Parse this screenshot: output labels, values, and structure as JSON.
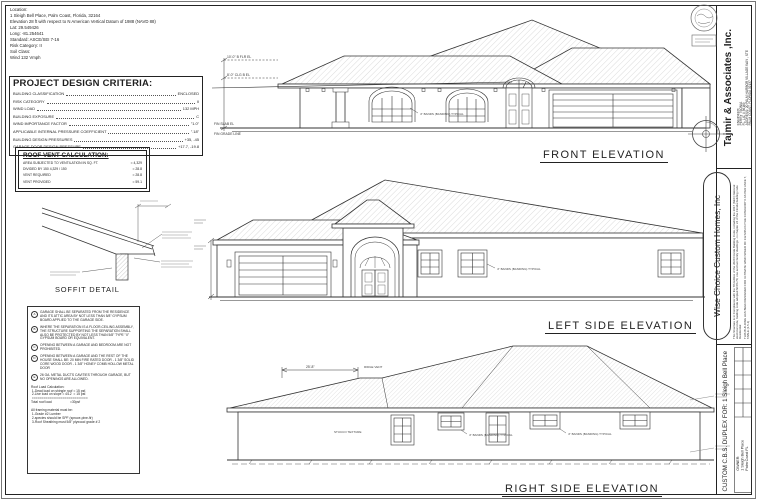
{
  "colors": {
    "paper": "#ffffff",
    "ink": "#1f1f1f",
    "hatch": "#b8b8b8"
  },
  "sheet": {
    "location": {
      "lines": [
        "Location:",
        "1 Sleigh Bell Place, Palm Coast, Florida, 32164",
        "Elevation 28 ft with respect to N American Vertical Datum of 1988 (NAVD 88)",
        "Lat:     29.549426",
        "Long:  -81.254641",
        "Standard:      ASCE/SEI 7-16",
        "Risk Category:        II",
        "Soil Class:",
        "Wind 132 Vmph"
      ]
    },
    "design_criteria": {
      "title": "PROJECT DESIGN CRITERIA:",
      "rows": [
        {
          "label": "BUILDING CLASSIFICATION",
          "value": "ENCLOSED"
        },
        {
          "label": "RISK CATEGORY",
          "value": "II"
        },
        {
          "label": "WIND LOAD",
          "value": "132 MPH"
        },
        {
          "label": "BUILDING EXPOSURE",
          "value": "C"
        },
        {
          "label": "WIND IMPORTANCE FACTOR",
          "value": "\"1.0\""
        },
        {
          "label": "APPLICABLE INTERNAL PRESSURE COEFFICIENT",
          "value": "\".18\""
        },
        {
          "label": "BUILDING DESIGN PRESSURES",
          "value": "+35, -45"
        },
        {
          "label": "GARAGE DOOR DESIGN PRESSURE",
          "value": "+17.7, -19.8"
        }
      ]
    },
    "roof_vent": {
      "title": "ROOF VENT CALCULATION:",
      "rows": [
        {
          "label": "AREA SUBJECTED TO VENTILATION IN SQ. FT.",
          "value": "= 4,329"
        },
        {
          "label": "DIVIDED BY 150        4,329 / 150",
          "value": "= 28.8"
        },
        {
          "label": "VENT REQUIRED",
          "value": "= 28.8"
        },
        {
          "label": "VENT PROVIDED",
          "value": "= 59.1"
        }
      ]
    },
    "soffit": {
      "label": "SOFFIT DETAIL"
    },
    "notes": {
      "items": [
        {
          "key": "A",
          "text": "GARAGE SHALL BE SEPARATED FROM THE RESIDENCE AND ITS ATTIC AREA BY NOT LESS THAN 5/8\" GYPSUM BOARD APPLIED TO THE GARAGE SIDE."
        },
        {
          "key": "B",
          "text": "WHERE THE SEPARATION IS A FLOOR-CEILING ASSEMBLY, THE STRUCTURE SUPPORTING THE SEPARATION SHALL ALSO BE PROTECTED BY NOT LESS THAN 5/8\" TYPE \"X\" GYPSUM BOARD OR EQUIVALENT."
        },
        {
          "key": "C",
          "text": "OPENING BETWEEN A GARAGE AND BEDROOM ARE NOT PROHIBITED."
        },
        {
          "key": "D",
          "text": "OPENING BETWEEN A GARAGE AND THE REST OF THE HOUSE SHALL BE: 20 MIN FIRE RATED DOOR   - 1 3/8\" SOLID CORE WOOD DOOR   - 1 3/8\" HONEY COMB HOLLOW METAL DOOR"
        },
        {
          "key": "E",
          "text": "26 GA. METAL DUCTS CAVITIES THROUGH GARAGE, BUT NO OPENINGS ARE ALLOWED."
        }
      ],
      "roof_load": {
        "title": "Roof Load Calculation:",
        "lines": [
          " 1-Dead load on shingle roof = 15 psf.",
          " 2-Live load on slope = 4/12  = 15 psf.",
          " =============================",
          "Total roof load                    =30psf"
        ]
      },
      "framing": {
        "title": "All framing material must be:",
        "lines": [
          " 1-Grade #2 Lumber",
          " 2-species should be SPF (spruce-pine-fir)",
          " 3-Roof Sheathing must 5/8\" plywood grade # 2"
        ]
      }
    },
    "elevations": {
      "front": {
        "label": "FRONT ELEVATION",
        "dim_top": "10'-0\" B FLR EL",
        "dim_mid": "8'-0\" CLG B EL",
        "dim_slab": "FIN SLAB EL",
        "dim_grade": "FIN GRADE LINE",
        "band_note": "4\" BANDS (BANDING) TYPICAL"
      },
      "left": {
        "label": "LEFT SIDE ELEVATION",
        "band_note": "4\" BANDS (BANDING) TYPICAL"
      },
      "right": {
        "label": "RIGHT SIDE ELEVATION",
        "stucco_note": "STUCCO TEXTURE",
        "band_note": "4\" BANDS (BANDING) TYPICAL",
        "ridge_dim": "25'-8\"",
        "ridge_note": "RIDGE VENT"
      }
    },
    "titleblock": {
      "firm": "Tajmir & Associates ,Inc.",
      "engineer_lines": [
        "ENGINEER:",
        "PERRY TSONIA",
        "FL. LIC # 36169",
        "ADDRESS: 20 PALM HARBOR VILLAGE WAY , STE",
        "PALM COAST, FLORIDA 32137"
      ],
      "builder": "Wise Choice Custom Homes, Inc",
      "compliance": "This Structure is in Compliance with the 7th Edition of the 2020 Florida Building Code, including the 2017 (NEC) National electrical code, building code adopted NFPA 70, one and two family dwellings - in chapter 24 of the Florida building code Residential",
      "wind_note": "THIS BUILDING HAS BEEN DESIGNED FOR ULTIMATE WIND SPEED OF 132 MPH IN THE CATEGORY II AS PER ASCE 7, TABLE (1.5-1)",
      "project": "CUSTOM C.B.S. DUPLEX FOR: 1 Sleigh Bell Place",
      "owner_label": "OWNER:",
      "address_line1": "1 Sleigh Bell Place",
      "address_line2": "Palm Coast FL"
    }
  }
}
